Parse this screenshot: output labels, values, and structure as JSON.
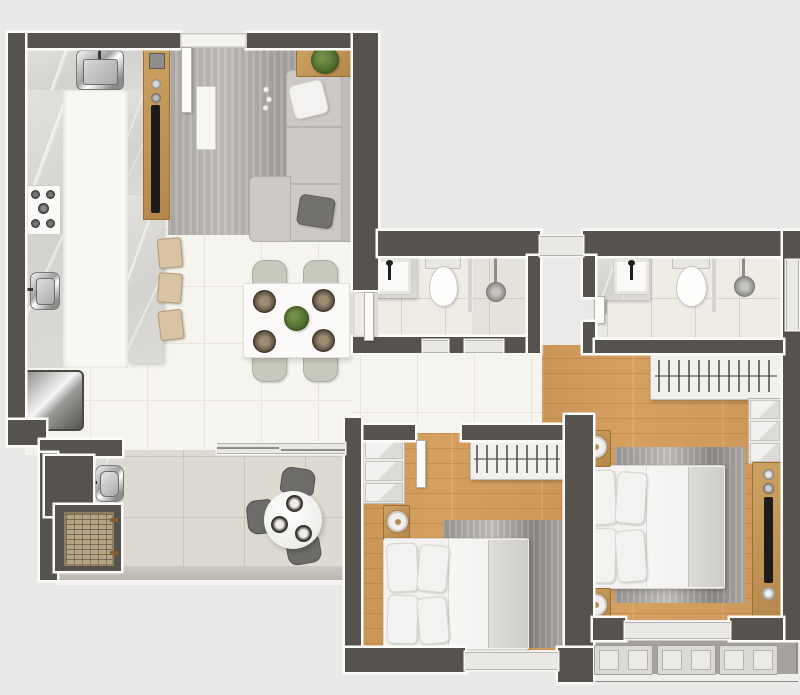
{
  "meta": {
    "type": "apartment-floor-plan-render",
    "view": "top-down",
    "units_text_visible": false
  },
  "colors": {
    "bg": "#e9e9e8",
    "wall": "#56534f",
    "outline": "#fcfcfb",
    "floor": "#f6f4ef",
    "grout": "#e7e4dd",
    "wood": "#d5a060",
    "balcony": "#dedad2",
    "glass": "#e9e8e5",
    "ledge": "#a5a29e",
    "rug_gray": "#b4b1ad",
    "sofa_gray": "#ccc9c6",
    "plant_green": "#5b7836",
    "stool_tan": "#d8c3a3",
    "tv_black": "#1c1b1a"
  },
  "rooms": [
    {
      "name": "kitchen",
      "furniture": [
        "counter-sink",
        "cooktop-5-burners",
        "prep-sink",
        "refrigerator",
        "island-aisle",
        "breakfast-bar",
        "counter-stools"
      ]
    },
    {
      "name": "living-room",
      "furniture": [
        "tv-panel",
        "tv",
        "intercom",
        "rug",
        "l-shaped-sofa",
        "side-table",
        "plant"
      ]
    },
    {
      "name": "dining-area",
      "furniture": [
        "dining-table",
        "dining-chairs",
        "place-settings",
        "centerpiece-plant"
      ]
    },
    {
      "name": "bathroom-1",
      "furniture": [
        "vanity-sink",
        "toilet",
        "glass-partition",
        "shower"
      ]
    },
    {
      "name": "bathroom-2",
      "furniture": [
        "vanity-sink",
        "toilet",
        "glass-partition",
        "shower",
        "window"
      ]
    },
    {
      "name": "bedroom-1",
      "furniture": [
        "wardrobe-drawers",
        "clothes-rail",
        "nightstand",
        "lamp",
        "double-bed",
        "rug"
      ]
    },
    {
      "name": "master-bedroom",
      "furniture": [
        "clothes-rail",
        "wardrobe-drawers",
        "double-bed",
        "rug",
        "nightstand-left",
        "nightstand-right",
        "tv-panel",
        "tv"
      ]
    },
    {
      "name": "balcony",
      "furniture": [
        "round-table",
        "chairs",
        "plates",
        "laundry-sink",
        "grill"
      ]
    },
    {
      "name": "service-ledge",
      "furniture": [
        "ac-condenser-units"
      ]
    }
  ],
  "counts": {
    "bedrooms": 2,
    "bathrooms": 2,
    "dining_chairs": 4,
    "dining_place_settings": 4,
    "counter_stools": 3,
    "balcony_chairs": 3,
    "balcony_place_settings": 3,
    "ac_units": 3,
    "bed_pillows_each": 4,
    "wardrobe_drawer_stacks": 2
  }
}
